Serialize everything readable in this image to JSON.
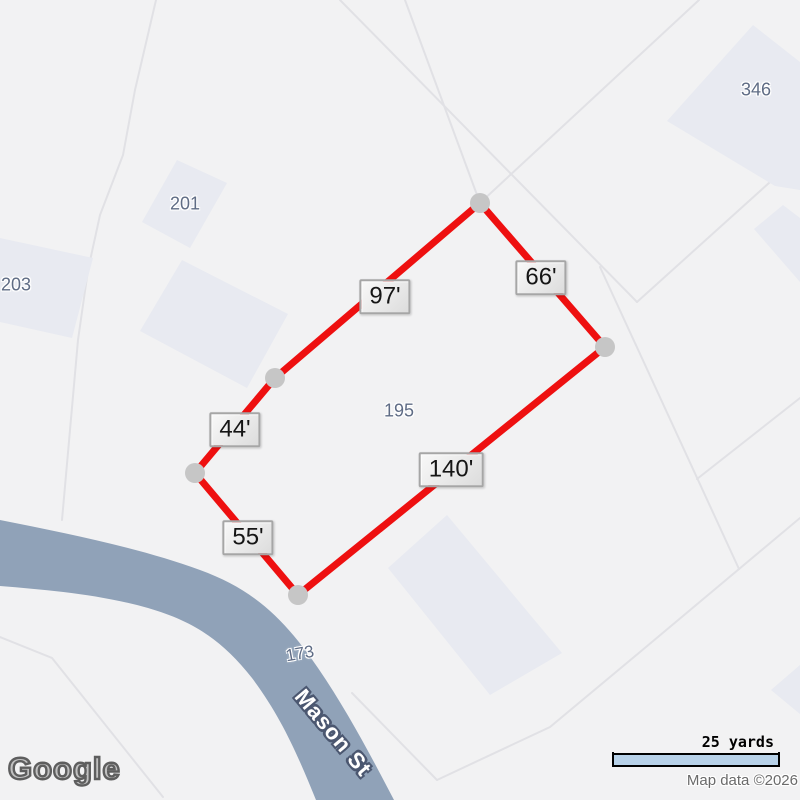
{
  "map": {
    "colors": {
      "background": "#f2f2f3",
      "parcel_line": "#e1e1e5",
      "building": "#e8eaf1",
      "road": "#90a2b8",
      "lot_outline": "#ee1010",
      "vertex": "#c6c6c6",
      "lot_number_text": "#5f6c85",
      "street_text": "#ffffff",
      "street_halo": "#4b5770",
      "scale_bar_fill": "#b7d1e8"
    },
    "highlighted_lot": {
      "number": "195",
      "side_lengths_feet": [
        97,
        66,
        140,
        55,
        44
      ]
    },
    "measurements": [
      {
        "label": "97'"
      },
      {
        "label": "66'"
      },
      {
        "label": "44'"
      },
      {
        "label": "140'"
      },
      {
        "label": "55'"
      }
    ],
    "parcel_labels": [
      {
        "text": "346"
      },
      {
        "text": "201"
      },
      {
        "text": "203"
      },
      {
        "text": "195"
      },
      {
        "text": "173"
      }
    ],
    "street": {
      "name": "Mason St"
    },
    "footer": {
      "logo": "Google",
      "scale_label": "25 yards",
      "attribution": "Map data ©2026"
    }
  }
}
